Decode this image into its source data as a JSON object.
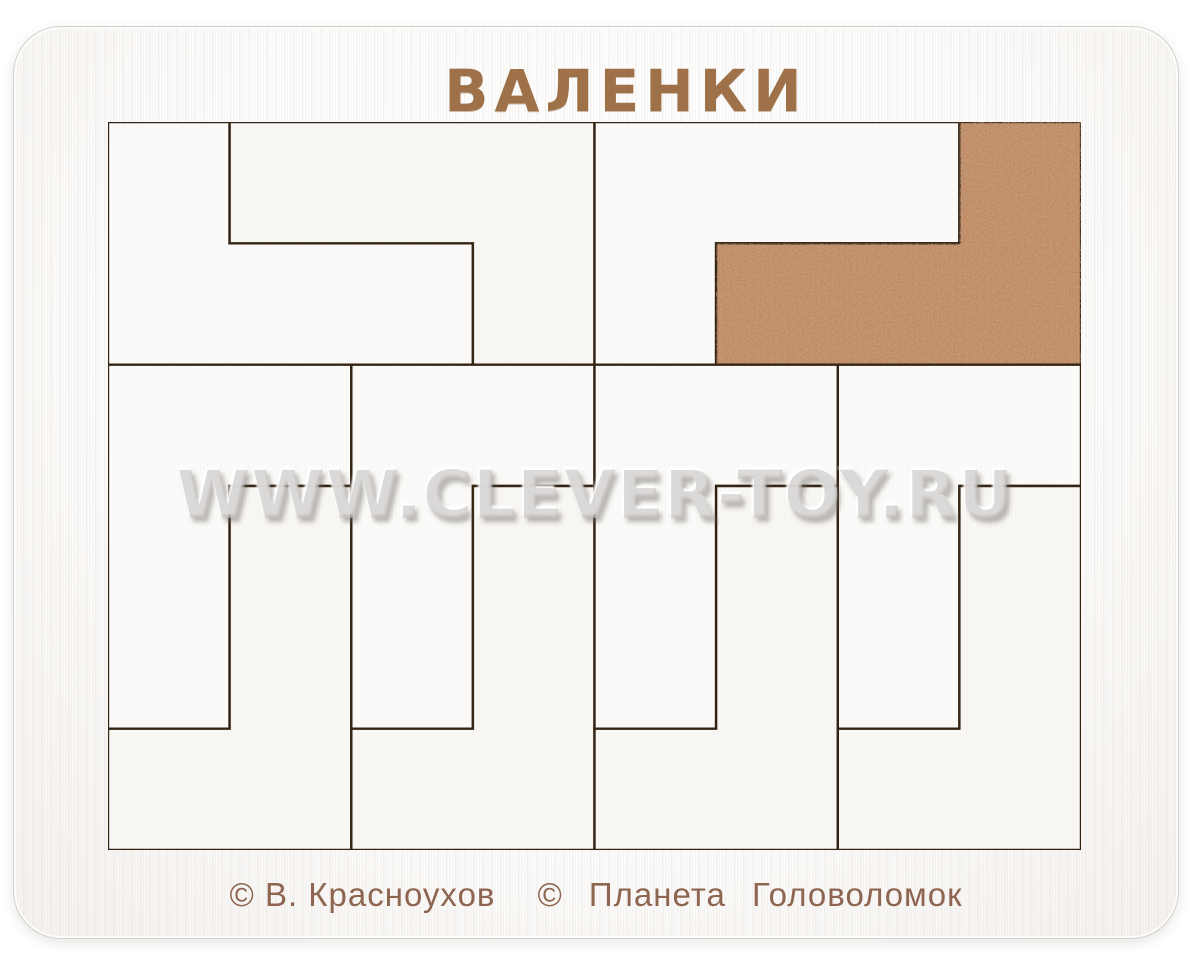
{
  "title": "ВАЛЕНКИ",
  "watermark": "WWW.CLEVER-TOY.RU",
  "credits": {
    "author": "© В. Красноухов",
    "publisher": "© Планета Головоломок"
  },
  "colors": {
    "title_engraving": "#9e7148",
    "credits_engraving": "#8d6550",
    "cut_line": "#31200f",
    "white_piece": "#fcfbf9",
    "white_piece_alt": "#faf8f5",
    "brown_piece": "#c0885f",
    "board": "#fcfbfa",
    "tray_recess": "#efe9e2"
  },
  "puzzle": {
    "grid": {
      "cols": 8,
      "rows": 6
    },
    "tray": {
      "x": 107,
      "y": 121,
      "width": 973,
      "height": 728
    },
    "piece_shape": "L-tetromino",
    "pieces": [
      {
        "id": "piece-1-white-L",
        "fill": "white",
        "points": [
          [
            0,
            0
          ],
          [
            1,
            0
          ],
          [
            1,
            1
          ],
          [
            3,
            1
          ],
          [
            3,
            2
          ],
          [
            0,
            2
          ]
        ]
      },
      {
        "id": "piece-2-white-L",
        "fill": "white",
        "points": [
          [
            1,
            0
          ],
          [
            4,
            0
          ],
          [
            4,
            2
          ],
          [
            3,
            2
          ],
          [
            3,
            1
          ],
          [
            1,
            1
          ]
        ]
      },
      {
        "id": "piece-3-white-L",
        "fill": "white",
        "points": [
          [
            4,
            0
          ],
          [
            7,
            0
          ],
          [
            7,
            1
          ],
          [
            5,
            1
          ],
          [
            5,
            2
          ],
          [
            4,
            2
          ]
        ]
      },
      {
        "id": "piece-4-brown-L",
        "fill": "brown",
        "points": [
          [
            7,
            0
          ],
          [
            8,
            0
          ],
          [
            8,
            2
          ],
          [
            5,
            2
          ],
          [
            5,
            1
          ],
          [
            7,
            1
          ]
        ]
      },
      {
        "id": "piece-5-white-L",
        "fill": "white",
        "points": [
          [
            0,
            2
          ],
          [
            2,
            2
          ],
          [
            2,
            3
          ],
          [
            1,
            3
          ],
          [
            1,
            5
          ],
          [
            0,
            5
          ]
        ]
      },
      {
        "id": "piece-6-white-L",
        "fill": "white",
        "points": [
          [
            1,
            3
          ],
          [
            2,
            3
          ],
          [
            2,
            6
          ],
          [
            0,
            6
          ],
          [
            0,
            5
          ],
          [
            1,
            5
          ]
        ]
      },
      {
        "id": "piece-7-white-L",
        "fill": "white",
        "points": [
          [
            2,
            2
          ],
          [
            4,
            2
          ],
          [
            4,
            3
          ],
          [
            3,
            3
          ],
          [
            3,
            5
          ],
          [
            2,
            5
          ]
        ]
      },
      {
        "id": "piece-8-white-L",
        "fill": "white",
        "points": [
          [
            3,
            3
          ],
          [
            4,
            3
          ],
          [
            4,
            6
          ],
          [
            2,
            6
          ],
          [
            2,
            5
          ],
          [
            3,
            5
          ]
        ]
      },
      {
        "id": "piece-9-white-L",
        "fill": "white",
        "points": [
          [
            4,
            2
          ],
          [
            6,
            2
          ],
          [
            6,
            3
          ],
          [
            5,
            3
          ],
          [
            5,
            5
          ],
          [
            4,
            5
          ]
        ]
      },
      {
        "id": "piece-10-white-L",
        "fill": "white",
        "points": [
          [
            5,
            3
          ],
          [
            6,
            3
          ],
          [
            6,
            6
          ],
          [
            4,
            6
          ],
          [
            4,
            5
          ],
          [
            5,
            5
          ]
        ]
      },
      {
        "id": "piece-11-white-L",
        "fill": "white",
        "points": [
          [
            6,
            2
          ],
          [
            8,
            2
          ],
          [
            8,
            3
          ],
          [
            7,
            3
          ],
          [
            7,
            5
          ],
          [
            6,
            5
          ]
        ]
      },
      {
        "id": "piece-12-white-L",
        "fill": "white",
        "points": [
          [
            7,
            3
          ],
          [
            8,
            3
          ],
          [
            8,
            6
          ],
          [
            6,
            6
          ],
          [
            6,
            5
          ],
          [
            7,
            5
          ]
        ]
      }
    ]
  }
}
